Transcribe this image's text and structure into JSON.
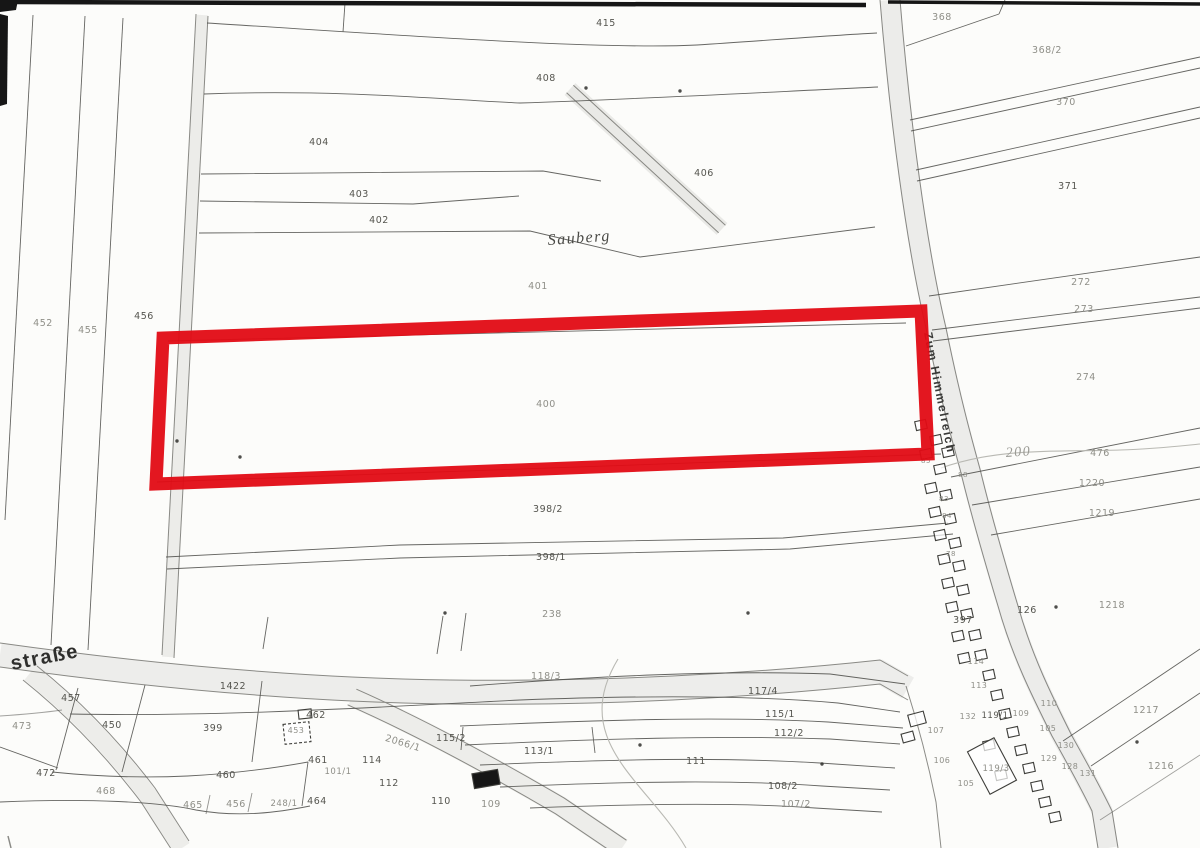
{
  "map": {
    "type": "scanned-cadastral-map",
    "colors": {
      "paper": "#fcfcfa",
      "line": "#4a4a46",
      "line_faint": "#8d8d87",
      "road_fill": "#ececea",
      "label": "#55554f",
      "label_faint": "#8f8f88",
      "contour": "#b9b9b3",
      "ink_artifact": "#161616",
      "highlight_red": "#e10b14"
    },
    "highlight": {
      "parcel": "400",
      "points": "163,338 921,311 928,454 156,484",
      "stroke_width": 13,
      "color": "#e10b14"
    },
    "street_labels": [
      {
        "t": "straße",
        "x": 12,
        "y": 670,
        "s": 20,
        "r": -11,
        "cls": "street-bold",
        "c": "#2e2e2c"
      },
      {
        "t": "Sauberg",
        "x": 548,
        "y": 245,
        "s": 16,
        "r": -4,
        "cls": "street-italic",
        "c": "#4a4a46"
      },
      {
        "t": "Zum Himmelreich",
        "x": 924,
        "y": 333,
        "s": 12,
        "r": 79,
        "cls": "street-bold",
        "c": "#3a3a38"
      },
      {
        "t": "200",
        "x": 1006,
        "y": 457,
        "s": 14,
        "r": -4,
        "cls": "street-italic",
        "c": "#9a9a94"
      }
    ],
    "parcel_labels": [
      {
        "t": "415",
        "x": 606,
        "y": 26
      },
      {
        "t": "408",
        "x": 546,
        "y": 81
      },
      {
        "t": "404",
        "x": 319,
        "y": 145
      },
      {
        "t": "406",
        "x": 704,
        "y": 176
      },
      {
        "t": "403",
        "x": 359,
        "y": 197
      },
      {
        "t": "402",
        "x": 379,
        "y": 223
      },
      {
        "t": "401",
        "x": 538,
        "y": 289,
        "f": true
      },
      {
        "t": "456",
        "x": 144,
        "y": 319
      },
      {
        "t": "452",
        "x": 43,
        "y": 326,
        "f": true
      },
      {
        "t": "455",
        "x": 88,
        "y": 333,
        "f": true
      },
      {
        "t": "400",
        "x": 546,
        "y": 407,
        "f": true
      },
      {
        "t": "368",
        "x": 942,
        "y": 20,
        "f": true
      },
      {
        "t": "368/2",
        "x": 1047,
        "y": 53,
        "f": true
      },
      {
        "t": "370",
        "x": 1066,
        "y": 105,
        "f": true
      },
      {
        "t": "371",
        "x": 1068,
        "y": 189
      },
      {
        "t": "272",
        "x": 1081,
        "y": 285,
        "f": true
      },
      {
        "t": "273",
        "x": 1084,
        "y": 312,
        "f": true
      },
      {
        "t": "274",
        "x": 1086,
        "y": 380,
        "f": true
      },
      {
        "t": "476",
        "x": 1100,
        "y": 456,
        "f": true
      },
      {
        "t": "1220",
        "x": 1092,
        "y": 486,
        "f": true
      },
      {
        "t": "1219",
        "x": 1102,
        "y": 516,
        "f": true
      },
      {
        "t": "398/2",
        "x": 548,
        "y": 512
      },
      {
        "t": "398/1",
        "x": 551,
        "y": 560
      },
      {
        "t": "238",
        "x": 552,
        "y": 617,
        "f": true
      },
      {
        "t": "397",
        "x": 963,
        "y": 623
      },
      {
        "t": "126",
        "x": 1027,
        "y": 613
      },
      {
        "t": "1218",
        "x": 1112,
        "y": 608,
        "f": true
      },
      {
        "t": "1217",
        "x": 1146,
        "y": 713,
        "f": true
      },
      {
        "t": "1216",
        "x": 1161,
        "y": 769,
        "f": true
      },
      {
        "t": "1422",
        "x": 233,
        "y": 689
      },
      {
        "t": "457",
        "x": 71,
        "y": 701
      },
      {
        "t": "450",
        "x": 112,
        "y": 728
      },
      {
        "t": "399",
        "x": 213,
        "y": 731
      },
      {
        "t": "473",
        "x": 22,
        "y": 729,
        "f": true
      },
      {
        "t": "472",
        "x": 46,
        "y": 776
      },
      {
        "t": "460",
        "x": 226,
        "y": 778
      },
      {
        "t": "468",
        "x": 106,
        "y": 794,
        "f": true
      },
      {
        "t": "462",
        "x": 316,
        "y": 718
      },
      {
        "t": "453",
        "x": 296,
        "y": 733,
        "f": true,
        "s": 8
      },
      {
        "t": "461",
        "x": 318,
        "y": 763
      },
      {
        "t": "101/1",
        "x": 338,
        "y": 774,
        "f": true,
        "s": 8.5
      },
      {
        "t": "464",
        "x": 317,
        "y": 804
      },
      {
        "t": "465",
        "x": 193,
        "y": 808,
        "f": true
      },
      {
        "t": "456",
        "x": 236,
        "y": 807,
        "f": true
      },
      {
        "t": "248/1",
        "x": 284,
        "y": 806,
        "f": true,
        "s": 8.5
      },
      {
        "t": "114",
        "x": 372,
        "y": 763
      },
      {
        "t": "112",
        "x": 389,
        "y": 786
      },
      {
        "t": "110",
        "x": 441,
        "y": 804
      },
      {
        "t": "109",
        "x": 491,
        "y": 807,
        "f": true
      },
      {
        "t": "2066/1",
        "x": 402,
        "y": 746,
        "r": 17,
        "f": true
      },
      {
        "t": "115/2",
        "x": 451,
        "y": 741
      },
      {
        "t": "113/1",
        "x": 539,
        "y": 754
      },
      {
        "t": "118/3",
        "x": 546,
        "y": 679,
        "f": true
      },
      {
        "t": "117/4",
        "x": 763,
        "y": 694
      },
      {
        "t": "115/1",
        "x": 780,
        "y": 717
      },
      {
        "t": "112/2",
        "x": 789,
        "y": 736
      },
      {
        "t": "111",
        "x": 696,
        "y": 764
      },
      {
        "t": "108/2",
        "x": 783,
        "y": 789
      },
      {
        "t": "107/2",
        "x": 796,
        "y": 807,
        "f": true
      },
      {
        "t": "114",
        "x": 976,
        "y": 664,
        "f": true,
        "s": 8
      },
      {
        "t": "113",
        "x": 979,
        "y": 688,
        "f": true,
        "s": 8
      },
      {
        "t": "132",
        "x": 968,
        "y": 719,
        "f": true,
        "s": 8
      },
      {
        "t": "119/1",
        "x": 995,
        "y": 718,
        "s": 8.5
      },
      {
        "t": "109",
        "x": 1021,
        "y": 716,
        "f": true,
        "s": 8
      },
      {
        "t": "110",
        "x": 1049,
        "y": 706,
        "f": true,
        "s": 8
      },
      {
        "t": "107",
        "x": 936,
        "y": 733,
        "f": true,
        "s": 8
      },
      {
        "t": "105",
        "x": 1048,
        "y": 731,
        "f": true,
        "s": 8
      },
      {
        "t": "130",
        "x": 1066,
        "y": 748,
        "f": true,
        "s": 8
      },
      {
        "t": "129",
        "x": 1049,
        "y": 761,
        "f": true,
        "s": 8
      },
      {
        "t": "128",
        "x": 1070,
        "y": 769,
        "f": true,
        "s": 8
      },
      {
        "t": "131",
        "x": 1088,
        "y": 776,
        "f": true,
        "s": 8
      },
      {
        "t": "106",
        "x": 942,
        "y": 763,
        "f": true,
        "s": 8
      },
      {
        "t": "105",
        "x": 966,
        "y": 786,
        "f": true,
        "s": 8
      },
      {
        "t": "119/3",
        "x": 996,
        "y": 771,
        "f": true,
        "s": 8.5
      },
      {
        "t": "88",
        "x": 963,
        "y": 477,
        "f": true,
        "s": 7
      },
      {
        "t": "85",
        "x": 926,
        "y": 463,
        "f": true,
        "s": 7
      },
      {
        "t": "83",
        "x": 944,
        "y": 501,
        "f": true,
        "s": 7
      },
      {
        "t": "84",
        "x": 947,
        "y": 518,
        "f": true,
        "s": 7
      },
      {
        "t": "78",
        "x": 951,
        "y": 556,
        "f": true,
        "s": 7
      }
    ],
    "buildings": [
      {
        "x": 921,
        "y": 425
      },
      {
        "x": 936,
        "y": 440
      },
      {
        "x": 948,
        "y": 452
      },
      {
        "x": 926,
        "y": 454
      },
      {
        "x": 940,
        "y": 469
      },
      {
        "x": 931,
        "y": 488
      },
      {
        "x": 946,
        "y": 495
      },
      {
        "x": 935,
        "y": 512
      },
      {
        "x": 950,
        "y": 519
      },
      {
        "x": 940,
        "y": 535
      },
      {
        "x": 955,
        "y": 543
      },
      {
        "x": 944,
        "y": 559
      },
      {
        "x": 959,
        "y": 566
      },
      {
        "x": 948,
        "y": 583
      },
      {
        "x": 963,
        "y": 590
      },
      {
        "x": 952,
        "y": 607
      },
      {
        "x": 967,
        "y": 614
      },
      {
        "x": 975,
        "y": 635
      },
      {
        "x": 958,
        "y": 636
      },
      {
        "x": 981,
        "y": 655
      },
      {
        "x": 964,
        "y": 658
      },
      {
        "x": 989,
        "y": 675
      },
      {
        "x": 997,
        "y": 695
      },
      {
        "x": 1005,
        "y": 714
      },
      {
        "x": 1013,
        "y": 732
      },
      {
        "x": 989,
        "y": 745
      },
      {
        "x": 1021,
        "y": 750
      },
      {
        "x": 1029,
        "y": 768
      },
      {
        "x": 1001,
        "y": 775
      },
      {
        "x": 1037,
        "y": 786
      },
      {
        "x": 1045,
        "y": 802
      },
      {
        "x": 1055,
        "y": 817
      },
      {
        "x": 917,
        "y": 719,
        "w": 16,
        "h": 12,
        "r": -15
      },
      {
        "x": 908,
        "y": 737,
        "w": 12,
        "h": 9,
        "r": -15
      },
      {
        "x": 992,
        "y": 766,
        "w": 30,
        "h": 48,
        "r": -28
      },
      {
        "x": 486,
        "y": 779,
        "w": 26,
        "h": 15,
        "r": -10,
        "type": "filled"
      },
      {
        "x": 305,
        "y": 714,
        "w": 13,
        "h": 9,
        "r": -6
      },
      {
        "x": 297,
        "y": 733,
        "w": 26,
        "h": 20,
        "r": -6,
        "type": "dashed"
      }
    ],
    "dots": [
      {
        "x": 445,
        "y": 613
      },
      {
        "x": 748,
        "y": 613
      },
      {
        "x": 1056,
        "y": 607
      },
      {
        "x": 680,
        "y": 91
      },
      {
        "x": 586,
        "y": 88
      },
      {
        "x": 240,
        "y": 457
      },
      {
        "x": 177,
        "y": 441
      },
      {
        "x": 1137,
        "y": 742
      },
      {
        "x": 640,
        "y": 745
      },
      {
        "x": 822,
        "y": 764
      }
    ]
  }
}
